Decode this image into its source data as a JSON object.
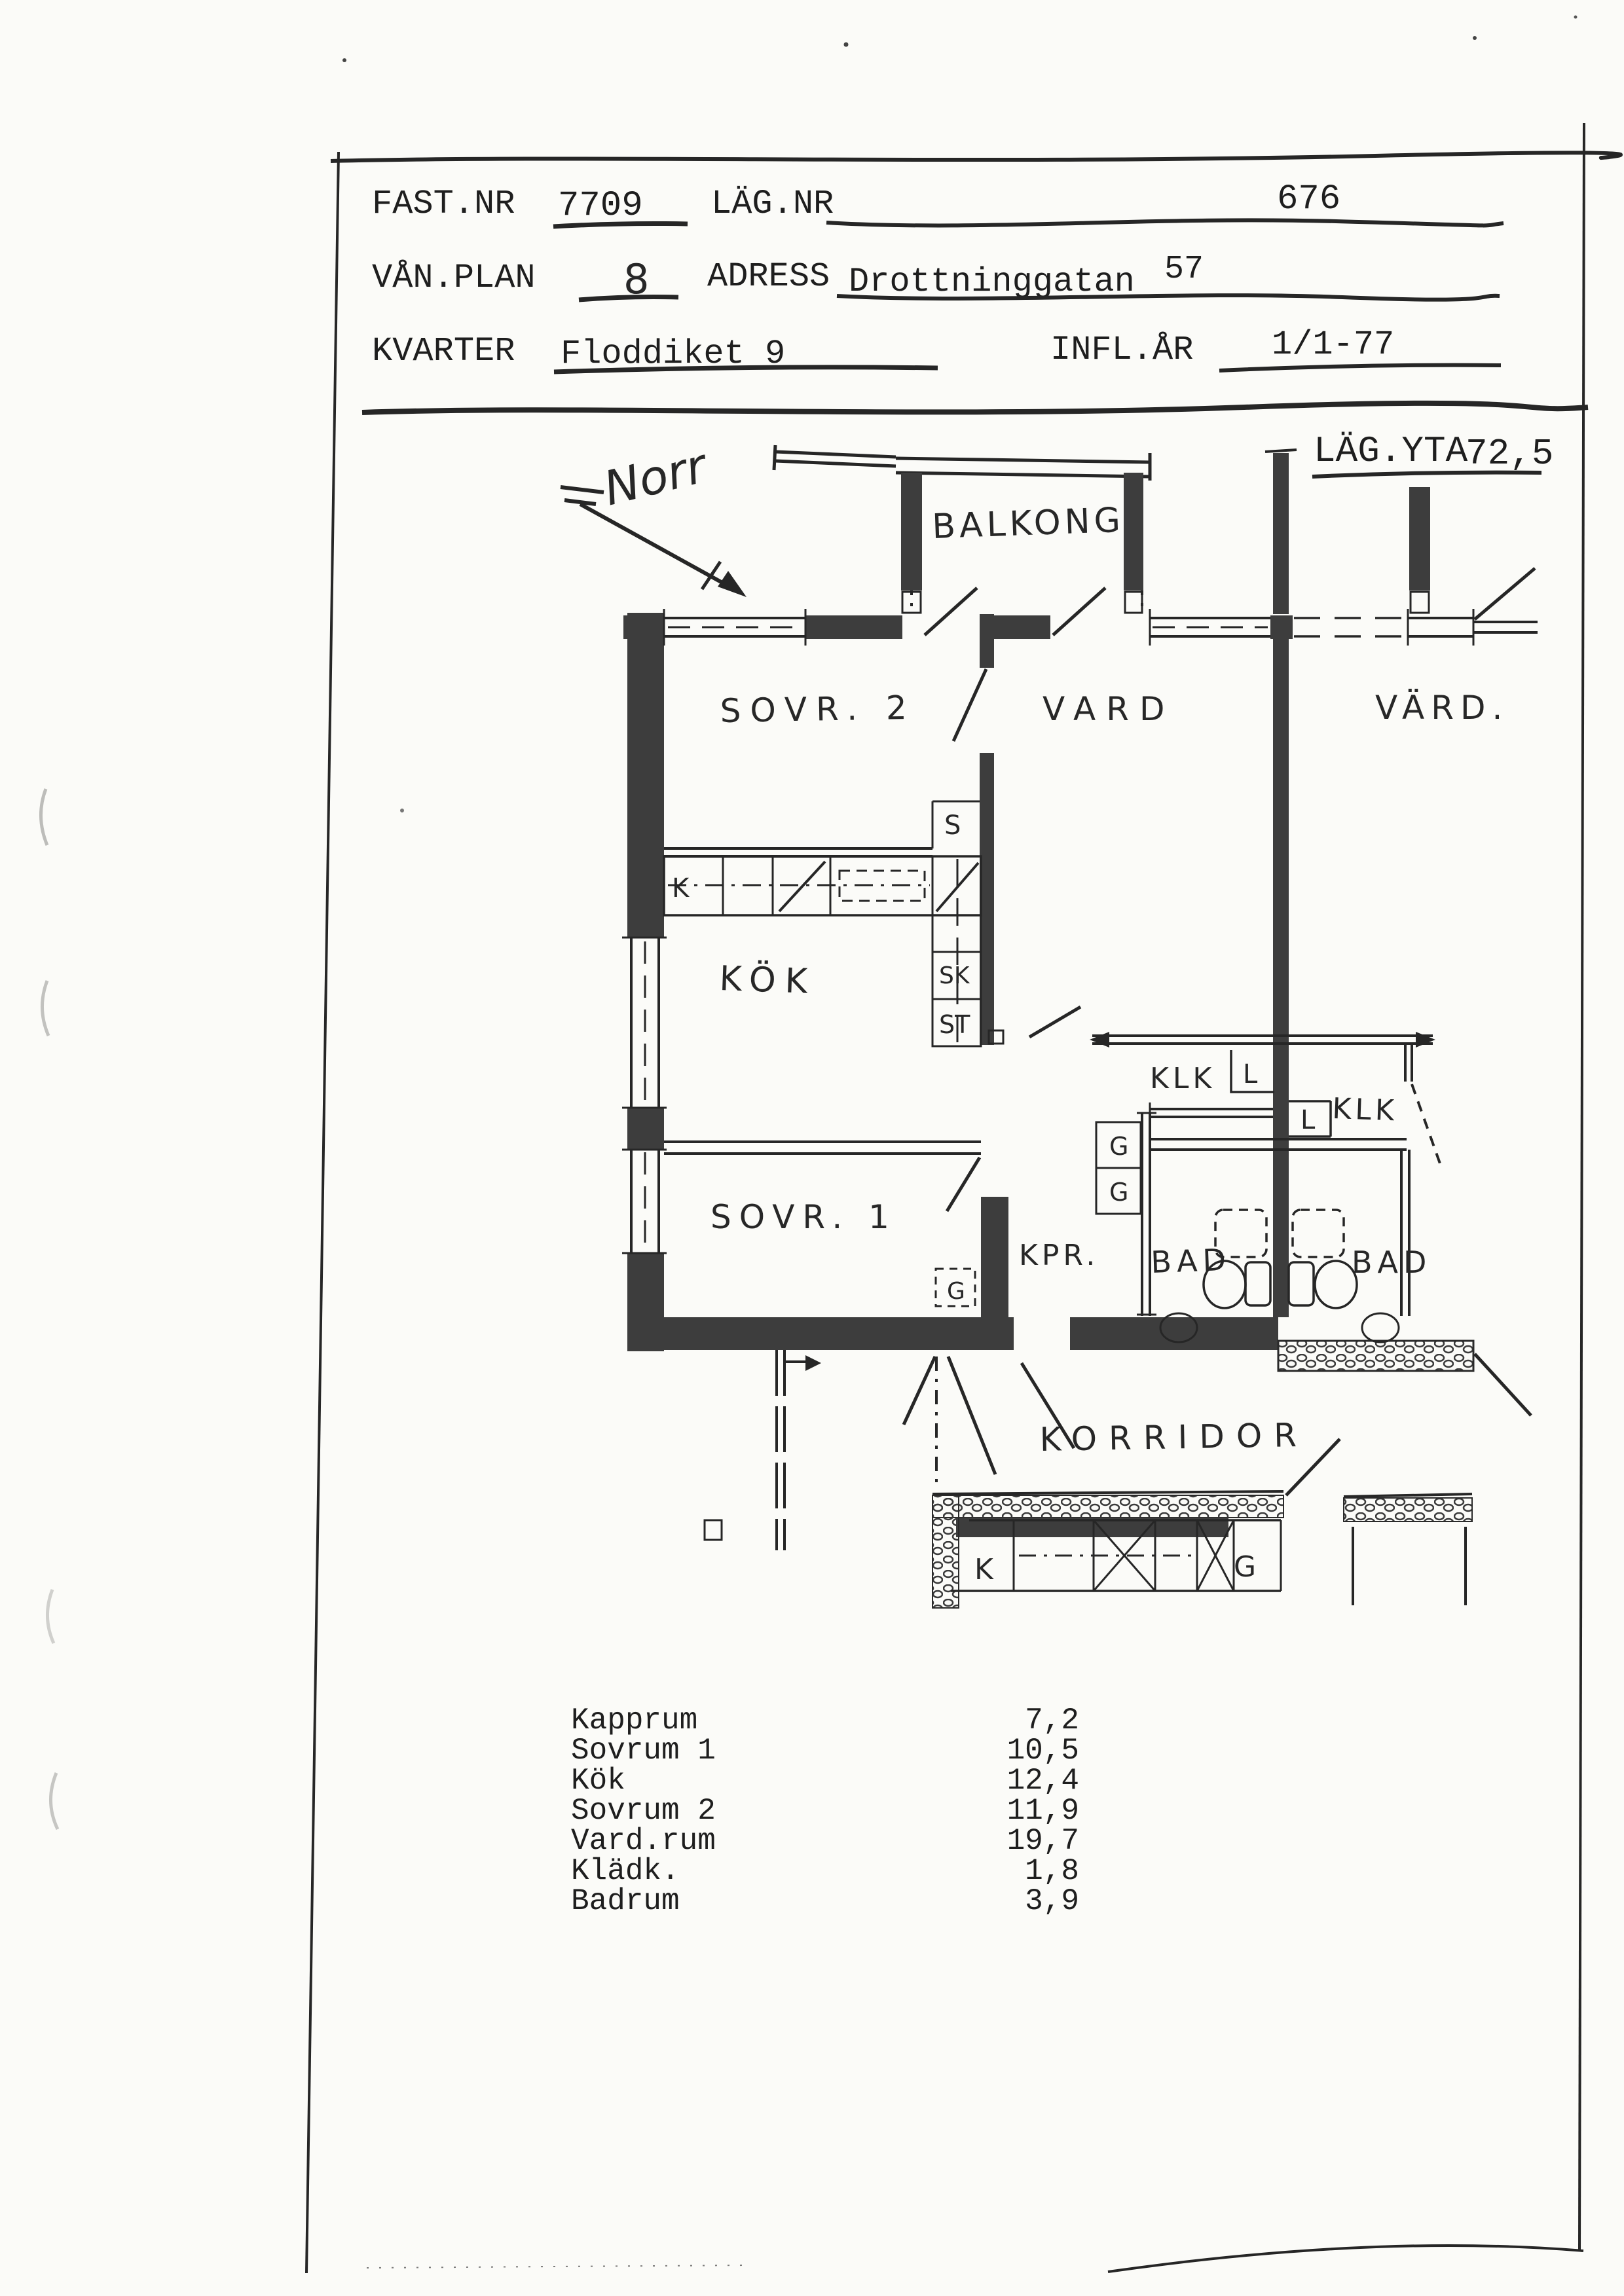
{
  "form": {
    "fast_label": "FAST.NR",
    "fast_value": "7709",
    "lag_label": "LÄG.NR",
    "lag_value": "676",
    "van_label": "VÅN.PLAN",
    "van_value": "8",
    "adress_label": "ADRESS",
    "adress_value": "Drottninggatan",
    "adress_number": "57",
    "kvarter_label": "KVARTER",
    "kvarter_value": "Floddiket 9",
    "infl_label": "INFL.ÅR",
    "infl_value": "1/1-77",
    "yta_label": "LÄG.YTA",
    "yta_value": "72,5"
  },
  "plan": {
    "north": "Norr",
    "balkong": "BALKONG",
    "sovr2": "SOVR. 2",
    "vard": "VARD",
    "vard_grann": "VÄRD.",
    "kok": "KÖK",
    "sovr1": "SOVR. 1",
    "kpr": "KPR.",
    "bad_left": "BAD",
    "bad_right": "BAD",
    "klk_left": "KLK",
    "klk_right": "KLK",
    "korridor": "KORRIDOR",
    "s": "S",
    "sk": "SK",
    "st": "ST",
    "k_bank": "K",
    "l_left": "L",
    "l_right": "L",
    "g1": "G",
    "g2": "G",
    "g_sovr1": "G",
    "k_nere": "K",
    "g_nere": "G"
  },
  "area_table": {
    "rows": [
      {
        "label": "Kapprum",
        "value": "7,2"
      },
      {
        "label": "Sovrum 1",
        "value": "10,5"
      },
      {
        "label": "Kök",
        "value": "12,4"
      },
      {
        "label": "Sovrum 2",
        "value": "11,9"
      },
      {
        "label": "Vard.rum",
        "value": "19,7"
      },
      {
        "label": "Klädk.",
        "value": "1,8"
      },
      {
        "label": "Badrum",
        "value": "3,9"
      }
    ]
  }
}
